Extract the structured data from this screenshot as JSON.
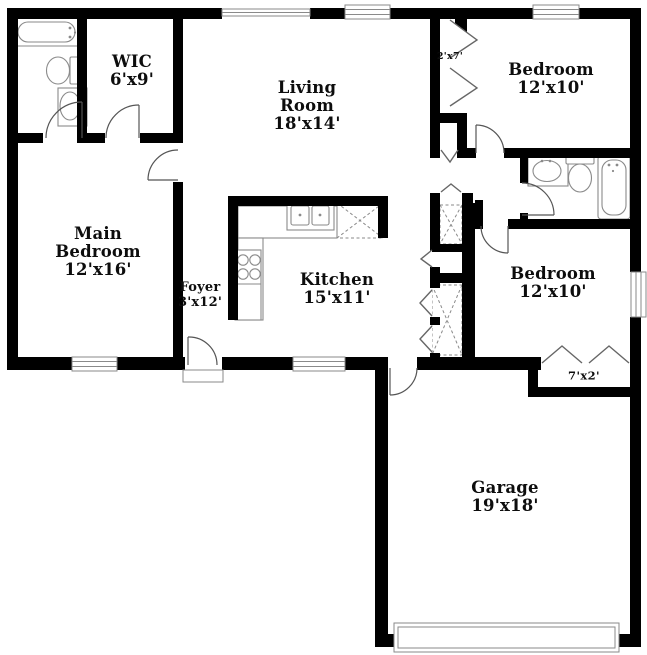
{
  "plan": {
    "type": "floor-plan",
    "colors": {
      "background": "#ffffff",
      "walls": "#000000",
      "fixtures": "#8a8a8a",
      "text": "#0d0d0d"
    },
    "rooms": [
      {
        "name": "WIC",
        "dims": "6'x9'"
      },
      {
        "name": "Living Room",
        "dims": "18'x14'"
      },
      {
        "name": "Bedroom",
        "dims": "12'x10'"
      },
      {
        "name": "Main Bedroom",
        "dims": "12'x16'"
      },
      {
        "name": "Foyer",
        "dims": "3'x12'"
      },
      {
        "name": "Kitchen",
        "dims": "15'x11'"
      },
      {
        "name": "Bedroom",
        "dims": "12'x10'"
      },
      {
        "name": "Garage",
        "dims": "19'x18'"
      },
      {
        "name": "",
        "dims": "2'x7'"
      },
      {
        "name": "",
        "dims": "7'x2'"
      }
    ]
  }
}
